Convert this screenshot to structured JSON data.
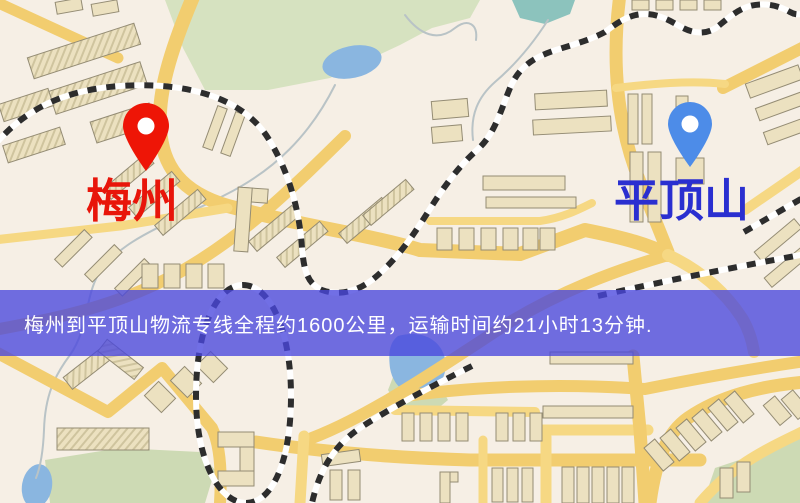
{
  "map": {
    "markers": [
      {
        "name": "梅州",
        "pin_color": "#ee1506",
        "label_color": "#e8150a"
      },
      {
        "name": "平顶山",
        "pin_color": "#4d8ce8",
        "label_color": "#2a2fd0"
      }
    ],
    "banner": {
      "text": "梅州到平顶山物流专线全程约1600公里，运输时间约21小时13分钟.",
      "background_color": "rgba(73,70,222,0.78)",
      "text_color": "#ffffff"
    },
    "colors": {
      "background": "#f6efe5",
      "road_major": "#f2cd6f",
      "road_minor": "#f6d883",
      "building": "#ece1c0",
      "building_outline": "#948c74",
      "park": "#d6e2c0",
      "water": "#8ab6e0",
      "railway": "#2d2d2d"
    }
  }
}
